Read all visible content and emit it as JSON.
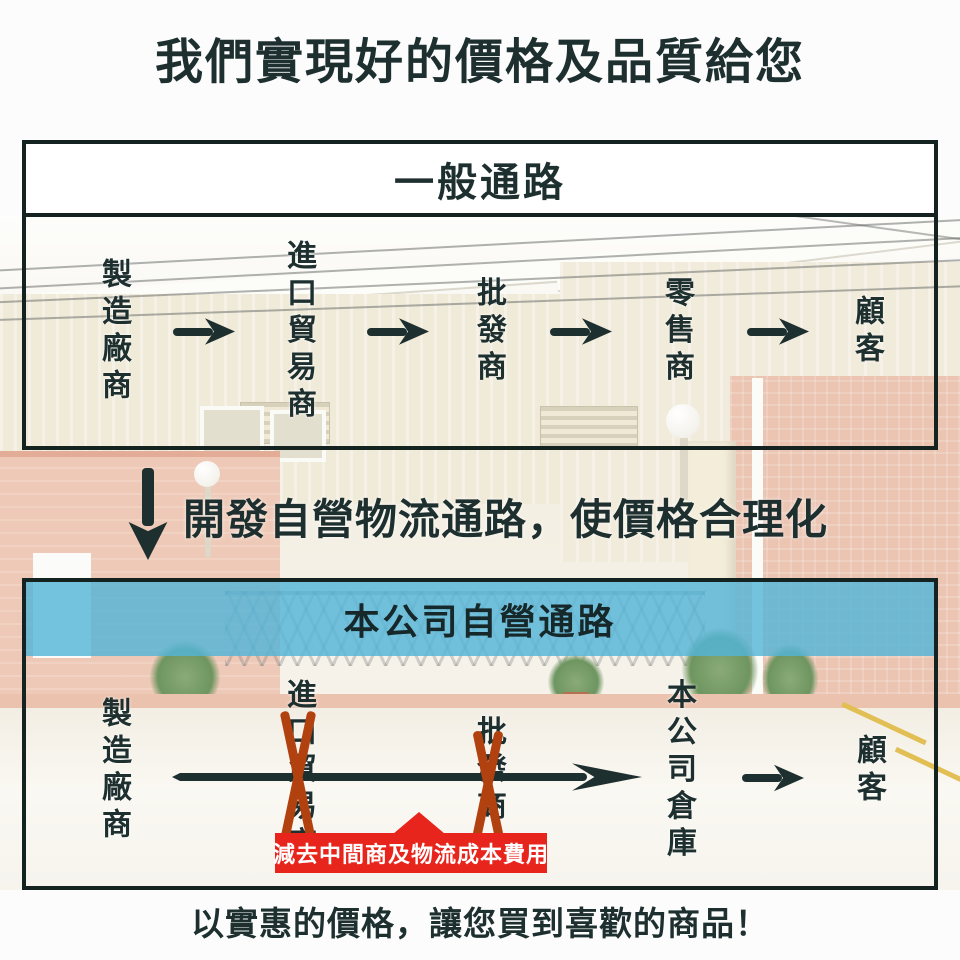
{
  "title": "我們實現好的價格及品質給您",
  "general_channel": {
    "header": "一般通路",
    "nodes": [
      "製造廠商",
      "進口貿易商",
      "批發商",
      "零售商",
      "顧客"
    ]
  },
  "transition": {
    "note": "開發自營物流通路，使價格合理化"
  },
  "own_channel": {
    "header": "本公司自營通路",
    "nodes": [
      "製造廠商",
      "進口貿易商",
      "批發商",
      "本公司倉庫",
      "顧客"
    ],
    "crossed_out_nodes": [
      "進口貿易商",
      "批發商"
    ],
    "cost_note": "減去中間商及物流成本費用"
  },
  "footer": {
    "note": "以實惠的價格，讓您買到喜歡的商品！"
  },
  "colors": {
    "ink": "#1e2f2f",
    "blue_band": "#54b4d8",
    "banner_red": "#e8251c",
    "cross_rust": "#b24110"
  }
}
